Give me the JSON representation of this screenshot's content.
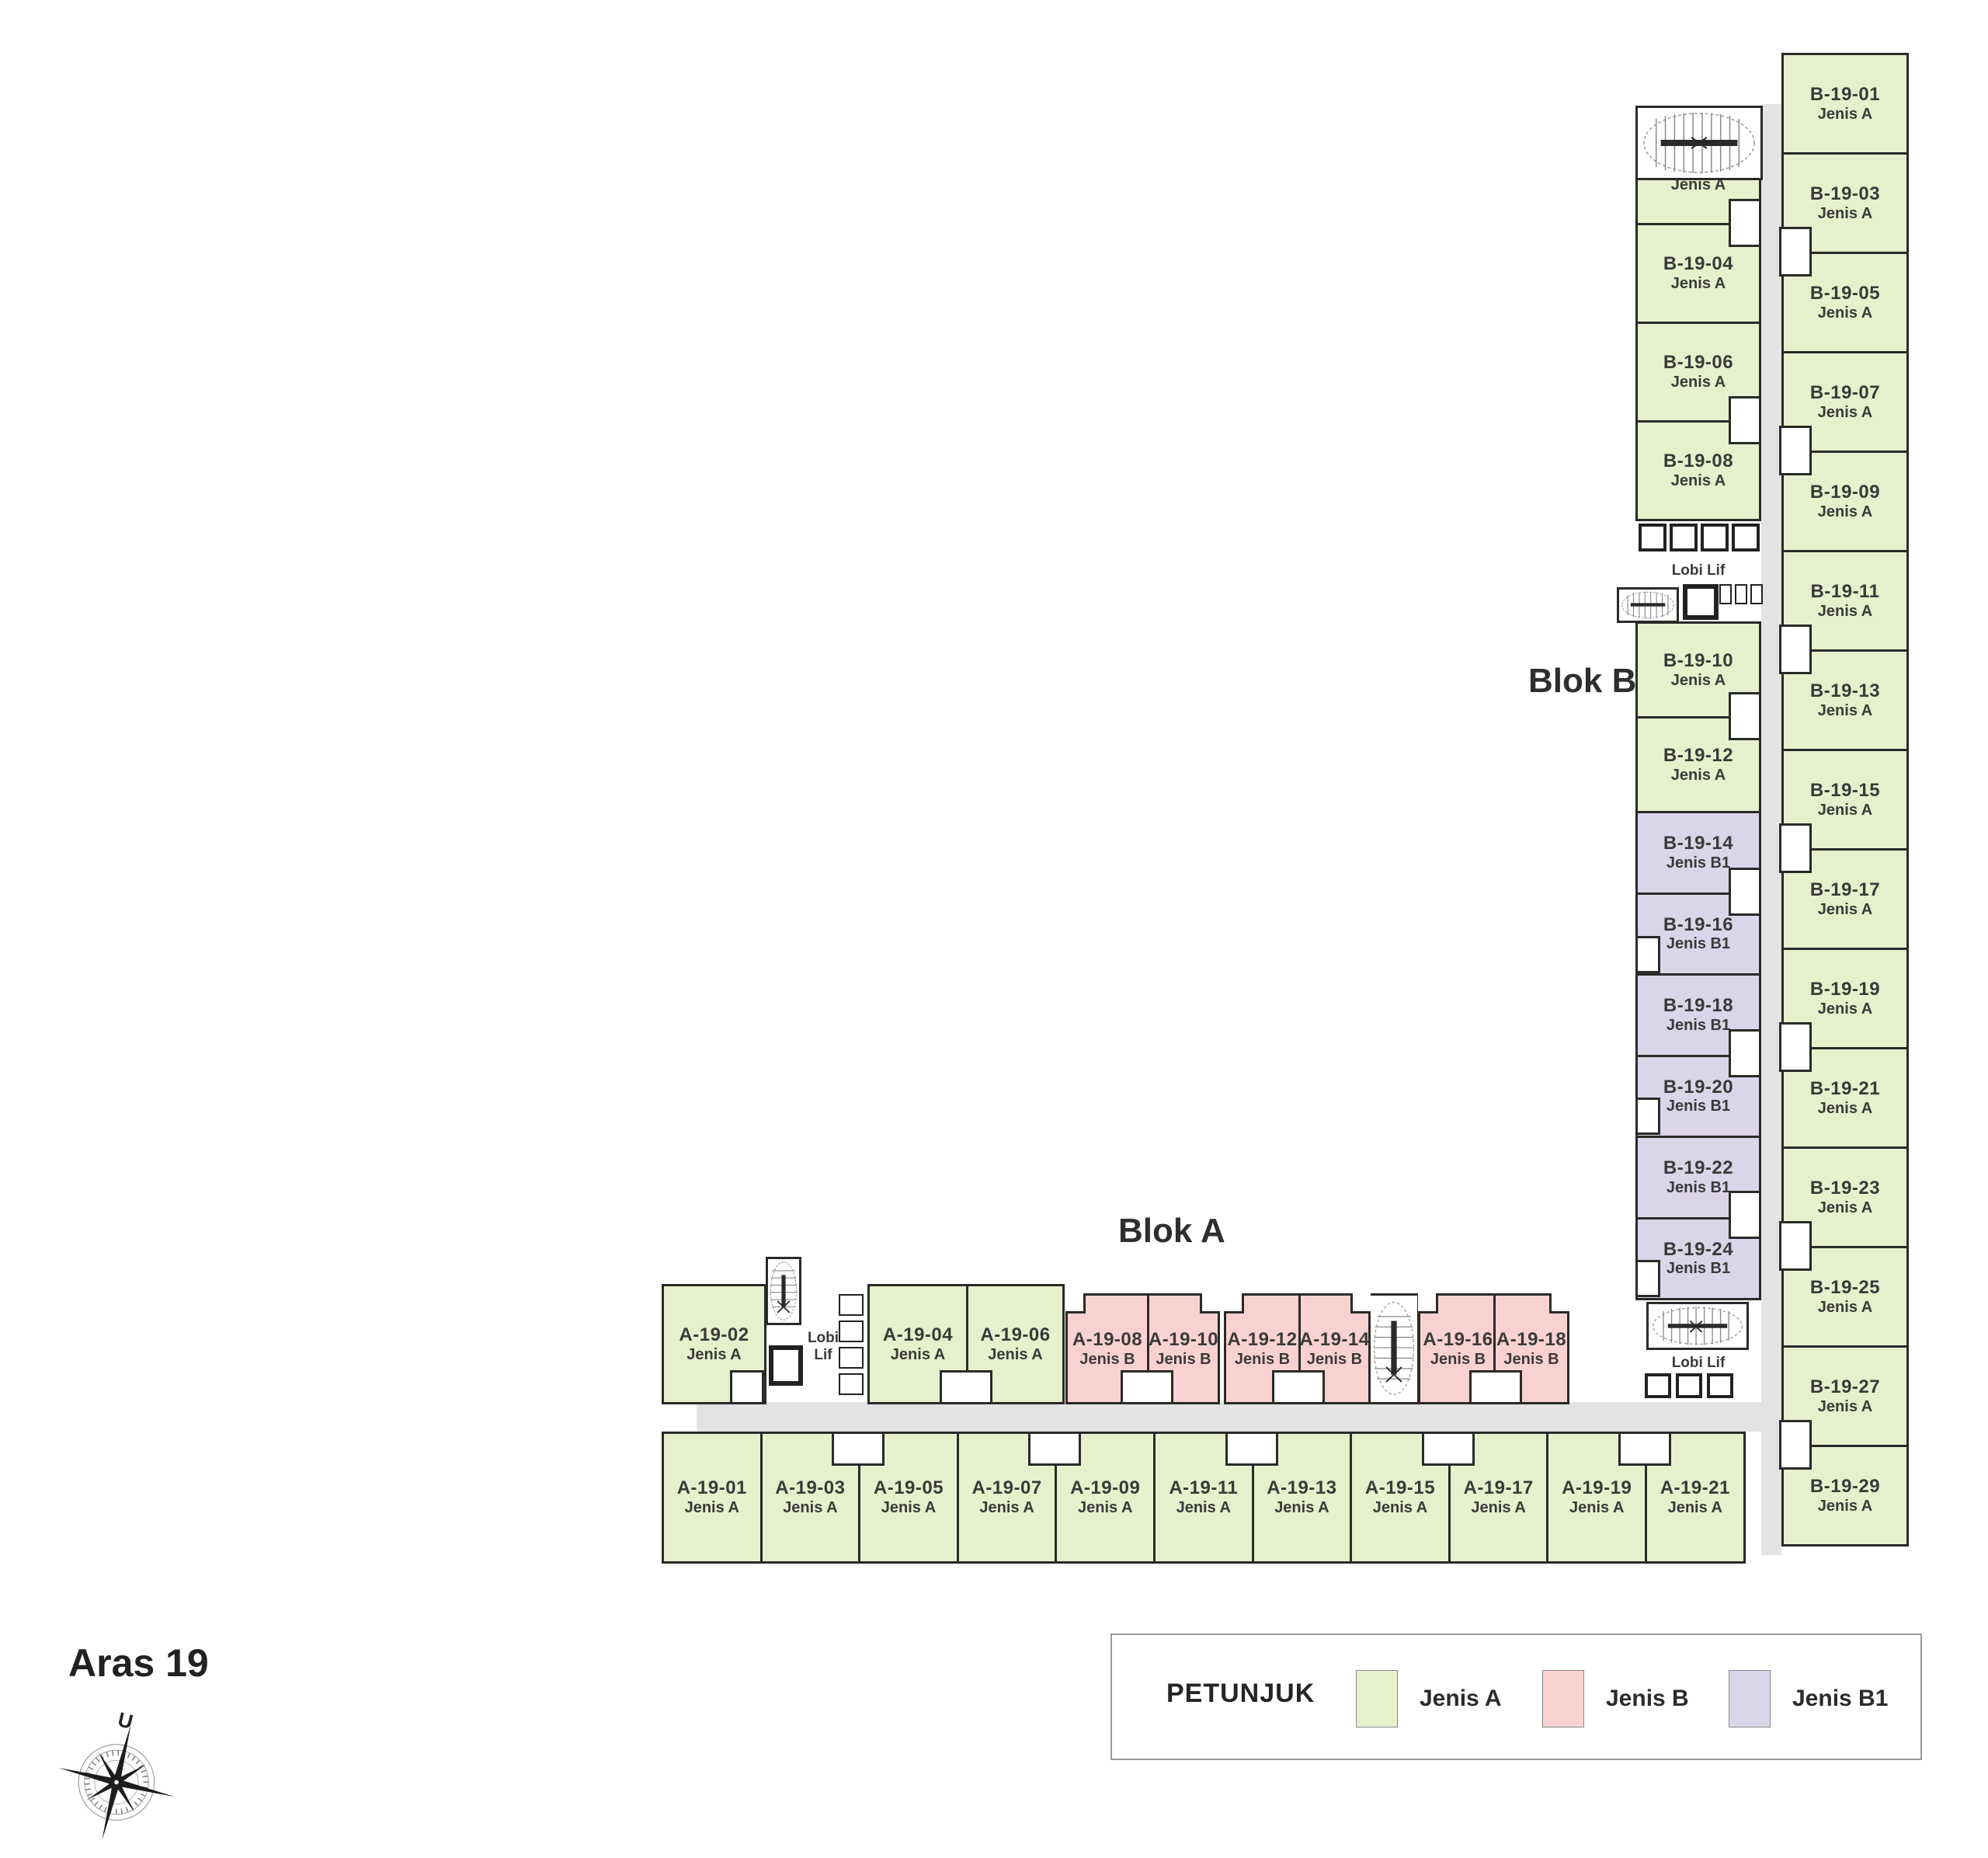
{
  "title": "Aras 19",
  "labels": {
    "blok_a": "Blok A",
    "blok_b": "Blok B",
    "lobby": "Lobi Lif",
    "north": "U"
  },
  "legend": {
    "title": "PETUNJUK",
    "items": [
      {
        "label": "Jenis A",
        "color": "#e6f0cd"
      },
      {
        "label": "Jenis B",
        "color": "#f9d2d0"
      },
      {
        "label": "Jenis B1",
        "color": "#dbd5ea"
      }
    ]
  },
  "colors": {
    "jenis_a": "#e6f0cd",
    "jenis_b": "#f9d2d0",
    "jenis_b1": "#dbd5ea",
    "corridor": "#e3e3e3",
    "outline": "#2a2a28"
  },
  "units": {
    "blok_b_right": [
      {
        "id": "B-19-01",
        "type": "Jenis A"
      },
      {
        "id": "B-19-03",
        "type": "Jenis A"
      },
      {
        "id": "B-19-05",
        "type": "Jenis A"
      },
      {
        "id": "B-19-07",
        "type": "Jenis A"
      },
      {
        "id": "B-19-09",
        "type": "Jenis A"
      },
      {
        "id": "B-19-11",
        "type": "Jenis A"
      },
      {
        "id": "B-19-13",
        "type": "Jenis A"
      },
      {
        "id": "B-19-15",
        "type": "Jenis A"
      },
      {
        "id": "B-19-17",
        "type": "Jenis A"
      },
      {
        "id": "B-19-19",
        "type": "Jenis A"
      },
      {
        "id": "B-19-21",
        "type": "Jenis A"
      },
      {
        "id": "B-19-23",
        "type": "Jenis A"
      },
      {
        "id": "B-19-25",
        "type": "Jenis A"
      },
      {
        "id": "B-19-27",
        "type": "Jenis A"
      },
      {
        "id": "B-19-29",
        "type": "Jenis A"
      }
    ],
    "blok_b_left": {
      "upper": [
        {
          "id": "B-19-02",
          "type": "Jenis A"
        },
        {
          "id": "B-19-04",
          "type": "Jenis A"
        },
        {
          "id": "B-19-06",
          "type": "Jenis A"
        },
        {
          "id": "B-19-08",
          "type": "Jenis A"
        }
      ],
      "mid": [
        {
          "id": "B-19-10",
          "type": "Jenis A"
        },
        {
          "id": "B-19-12",
          "type": "Jenis A"
        }
      ],
      "lower": [
        {
          "id": "B-19-14",
          "type": "Jenis B1"
        },
        {
          "id": "B-19-16",
          "type": "Jenis B1"
        },
        {
          "id": "B-19-18",
          "type": "Jenis B1"
        },
        {
          "id": "B-19-20",
          "type": "Jenis B1"
        },
        {
          "id": "B-19-22",
          "type": "Jenis B1"
        },
        {
          "id": "B-19-24",
          "type": "Jenis B1"
        }
      ]
    },
    "blok_a_top": [
      {
        "id": "A-19-02",
        "type": "Jenis A"
      },
      {
        "id": "A-19-04",
        "type": "Jenis A"
      },
      {
        "id": "A-19-06",
        "type": "Jenis A"
      },
      {
        "id": "A-19-08",
        "type": "Jenis B"
      },
      {
        "id": "A-19-10",
        "type": "Jenis B"
      },
      {
        "id": "A-19-12",
        "type": "Jenis B"
      },
      {
        "id": "A-19-14",
        "type": "Jenis B"
      },
      {
        "id": "A-19-16",
        "type": "Jenis B"
      },
      {
        "id": "A-19-18",
        "type": "Jenis B"
      }
    ],
    "blok_a_bottom": [
      {
        "id": "A-19-01",
        "type": "Jenis A"
      },
      {
        "id": "A-19-03",
        "type": "Jenis A"
      },
      {
        "id": "A-19-05",
        "type": "Jenis A"
      },
      {
        "id": "A-19-07",
        "type": "Jenis A"
      },
      {
        "id": "A-19-09",
        "type": "Jenis A"
      },
      {
        "id": "A-19-11",
        "type": "Jenis A"
      },
      {
        "id": "A-19-13",
        "type": "Jenis A"
      },
      {
        "id": "A-19-15",
        "type": "Jenis A"
      },
      {
        "id": "A-19-17",
        "type": "Jenis A"
      },
      {
        "id": "A-19-19",
        "type": "Jenis A"
      },
      {
        "id": "A-19-21",
        "type": "Jenis A"
      }
    ]
  }
}
